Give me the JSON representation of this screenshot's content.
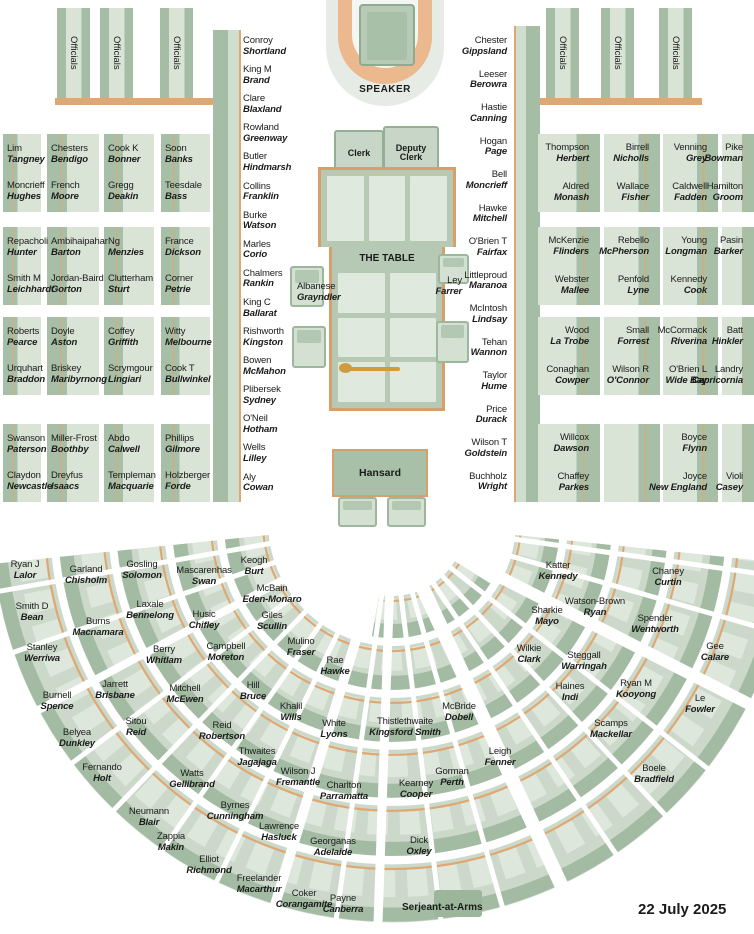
{
  "meta": {
    "date": "22 July 2025"
  },
  "labels": {
    "speaker": "SPEAKER",
    "clerk": "Clerk",
    "deputy_clerk": "Deputy Clerk",
    "the_table": "THE TABLE",
    "hansard": "Hansard",
    "serjeant": "Serjeant-at-Arms",
    "officials": "Officials"
  },
  "colors": {
    "bench_dark": "#a4bda4",
    "bench_light": "#d9e4d7",
    "accent_tan": "#dfa873",
    "mace_gold": "#d09a3e"
  },
  "table_seats": {
    "left": {
      "name": "Albanese",
      "electorate": "Grayndler"
    },
    "right": {
      "name": "Ley",
      "electorate": "Farrer"
    }
  },
  "left_bench_rows": [
    [
      [
        {
          "name": "Lim",
          "electorate": "Tangney"
        },
        {
          "name": "Moncrieff",
          "electorate": "Hughes"
        }
      ],
      [
        {
          "name": "Chesters",
          "electorate": "Bendigo"
        },
        {
          "name": "French",
          "electorate": "Moore"
        }
      ],
      [
        {
          "name": "Cook K",
          "electorate": "Bonner"
        },
        {
          "name": "Gregg",
          "electorate": "Deakin"
        }
      ],
      [
        {
          "name": "Soon",
          "electorate": "Banks"
        },
        {
          "name": "Teesdale",
          "electorate": "Bass"
        }
      ]
    ],
    [
      [
        {
          "name": "Repacholi",
          "electorate": "Hunter"
        },
        {
          "name": "Smith M",
          "electorate": "Leichhardt"
        }
      ],
      [
        {
          "name": "Ambihaipahar",
          "electorate": "Barton"
        },
        {
          "name": "Jordan-Baird",
          "electorate": "Gorton"
        }
      ],
      [
        {
          "name": "Ng",
          "electorate": "Menzies"
        },
        {
          "name": "Clutterham",
          "electorate": "Sturt"
        }
      ],
      [
        {
          "name": "France",
          "electorate": "Dickson"
        },
        {
          "name": "Corner",
          "electorate": "Petrie"
        }
      ]
    ],
    [
      [
        {
          "name": "Roberts",
          "electorate": "Pearce"
        },
        {
          "name": "Urquhart",
          "electorate": "Braddon"
        }
      ],
      [
        {
          "name": "Doyle",
          "electorate": "Aston"
        },
        {
          "name": "Briskey",
          "electorate": "Maribyrnong"
        }
      ],
      [
        {
          "name": "Coffey",
          "electorate": "Griffith"
        },
        {
          "name": "Scrymgour",
          "electorate": "Lingiari"
        }
      ],
      [
        {
          "name": "Witty",
          "electorate": "Melbourne"
        },
        {
          "name": "Cook T",
          "electorate": "Bullwinkel"
        }
      ]
    ],
    [
      [
        {
          "name": "Swanson",
          "electorate": "Paterson"
        },
        {
          "name": "Claydon",
          "electorate": "Newcastle"
        }
      ],
      [
        {
          "name": "Miller-Frost",
          "electorate": "Boothby"
        },
        {
          "name": "Dreyfus",
          "electorate": "Isaacs"
        }
      ],
      [
        {
          "name": "Abdo",
          "electorate": "Calwell"
        },
        {
          "name": "Templeman",
          "electorate": "Macquarie"
        }
      ],
      [
        {
          "name": "Phillips",
          "electorate": "Gilmore"
        },
        {
          "name": "Holzberger",
          "electorate": "Forde"
        }
      ]
    ]
  ],
  "right_bench_rows": [
    [
      [
        {
          "name": "Thompson",
          "electorate": "Herbert"
        },
        {
          "name": "Aldred",
          "electorate": "Monash"
        }
      ],
      [
        {
          "name": "Birrell",
          "electorate": "Nicholls"
        },
        {
          "name": "Wallace",
          "electorate": "Fisher"
        }
      ],
      [
        {
          "name": "Venning",
          "electorate": "Grey"
        },
        {
          "name": "Caldwell",
          "electorate": "Fadden"
        }
      ],
      [
        {
          "name": "Pike",
          "electorate": "Bowman"
        },
        {
          "name": "Hamilton",
          "electorate": "Groom"
        }
      ]
    ],
    [
      [
        {
          "name": "McKenzie",
          "electorate": "Flinders"
        },
        {
          "name": "Webster",
          "electorate": "Mallee"
        }
      ],
      [
        {
          "name": "Rebello",
          "electorate": "McPherson"
        },
        {
          "name": "Penfold",
          "electorate": "Lyne"
        }
      ],
      [
        {
          "name": "Young",
          "electorate": "Longman"
        },
        {
          "name": "Kennedy",
          "electorate": "Cook"
        }
      ],
      [
        {
          "name": "Pasin",
          "electorate": "Barker"
        },
        null
      ]
    ],
    [
      [
        {
          "name": "Wood",
          "electorate": "La Trobe"
        },
        {
          "name": "Conaghan",
          "electorate": "Cowper"
        }
      ],
      [
        {
          "name": "Small",
          "electorate": "Forrest"
        },
        {
          "name": "Wilson R",
          "electorate": "O'Connor"
        }
      ],
      [
        {
          "name": "McCormack",
          "electorate": "Riverina"
        },
        {
          "name": "O'Brien L",
          "electorate": "Wide Bay"
        }
      ],
      [
        {
          "name": "Batt",
          "electorate": "Hinkler"
        },
        {
          "name": "Landry",
          "electorate": "Capricornia"
        }
      ]
    ],
    [
      [
        {
          "name": "Willcox",
          "electorate": "Dawson"
        },
        {
          "name": "Chaffey",
          "electorate": "Parkes"
        }
      ],
      [
        null,
        null
      ],
      [
        {
          "name": "Boyce",
          "electorate": "Flynn"
        },
        {
          "name": "Joyce",
          "electorate": "New England"
        }
      ],
      [
        null,
        {
          "name": "Violi",
          "electorate": "Casey"
        }
      ]
    ]
  ],
  "front_bench_left": [
    {
      "name": "Conroy",
      "electorate": "Shortland"
    },
    {
      "name": "King M",
      "electorate": "Brand"
    },
    {
      "name": "Clare",
      "electorate": "Blaxland"
    },
    {
      "name": "Rowland",
      "electorate": "Greenway"
    },
    {
      "name": "Butler",
      "electorate": "Hindmarsh"
    },
    {
      "name": "Collins",
      "electorate": "Franklin"
    },
    {
      "name": "Burke",
      "electorate": "Watson"
    },
    {
      "name": "Marles",
      "electorate": "Corio"
    },
    {
      "name": "Chalmers",
      "electorate": "Rankin"
    },
    {
      "name": "King C",
      "electorate": "Ballarat"
    },
    {
      "name": "Rishworth",
      "electorate": "Kingston"
    },
    {
      "name": "Bowen",
      "electorate": "McMahon"
    },
    {
      "name": "Plibersek",
      "electorate": "Sydney"
    },
    {
      "name": "O'Neil",
      "electorate": "Hotham"
    },
    {
      "name": "Wells",
      "electorate": "Lilley"
    },
    {
      "name": "Aly",
      "electorate": "Cowan"
    }
  ],
  "front_bench_right": [
    {
      "name": "Chester",
      "electorate": "Gippsland"
    },
    {
      "name": "Leeser",
      "electorate": "Berowra"
    },
    {
      "name": "Hastie",
      "electorate": "Canning"
    },
    {
      "name": "Hogan",
      "electorate": "Page"
    },
    {
      "name": "Bell",
      "electorate": "Moncrieff"
    },
    {
      "name": "Hawke",
      "electorate": "Mitchell"
    },
    {
      "name": "O'Brien T",
      "electorate": "Fairfax"
    },
    {
      "name": "Littleproud",
      "electorate": "Maranoa"
    },
    {
      "name": "McIntosh",
      "electorate": "Lindsay"
    },
    {
      "name": "Tehan",
      "electorate": "Wannon"
    },
    {
      "name": "Taylor",
      "electorate": "Hume"
    },
    {
      "name": "Price",
      "electorate": "Durack"
    },
    {
      "name": "Wilson T",
      "electorate": "Goldstein"
    },
    {
      "name": "Buchholz",
      "electorate": "Wright"
    }
  ],
  "fan_seats": [
    {
      "name": "Ryan J",
      "electorate": "Lalor",
      "x": 25,
      "y": 560
    },
    {
      "name": "Garland",
      "electorate": "Chisholm",
      "x": 86,
      "y": 565
    },
    {
      "name": "Gosling",
      "electorate": "Solomon",
      "x": 142,
      "y": 560
    },
    {
      "name": "Mascarenhas",
      "electorate": "Swan",
      "x": 204,
      "y": 566
    },
    {
      "name": "Keogh",
      "electorate": "Burt",
      "x": 254,
      "y": 556
    },
    {
      "name": "Smith D",
      "electorate": "Bean",
      "x": 32,
      "y": 602
    },
    {
      "name": "Burns",
      "electorate": "Macnamara",
      "x": 98,
      "y": 617
    },
    {
      "name": "Laxale",
      "electorate": "Bennelong",
      "x": 150,
      "y": 600
    },
    {
      "name": "Husic",
      "electorate": "Chifley",
      "x": 204,
      "y": 610
    },
    {
      "name": "McBain",
      "electorate": "Eden-Monaro",
      "x": 272,
      "y": 584
    },
    {
      "name": "Stanley",
      "electorate": "Werriwa",
      "x": 42,
      "y": 643
    },
    {
      "name": "Berry",
      "electorate": "Whitlam",
      "x": 164,
      "y": 645
    },
    {
      "name": "Campbell",
      "electorate": "Moreton",
      "x": 226,
      "y": 642
    },
    {
      "name": "Giles",
      "electorate": "Scullin",
      "x": 272,
      "y": 611
    },
    {
      "name": "Mulino",
      "electorate": "Fraser",
      "x": 301,
      "y": 637
    },
    {
      "name": "Rae",
      "electorate": "Hawke",
      "x": 335,
      "y": 656
    },
    {
      "name": "Burnell",
      "electorate": "Spence",
      "x": 57,
      "y": 691
    },
    {
      "name": "Jarrett",
      "electorate": "Brisbane",
      "x": 115,
      "y": 680
    },
    {
      "name": "Mitchell",
      "electorate": "McEwen",
      "x": 185,
      "y": 684
    },
    {
      "name": "Hill",
      "electorate": "Bruce",
      "x": 253,
      "y": 681
    },
    {
      "name": "Khalil",
      "electorate": "Wills",
      "x": 291,
      "y": 702
    },
    {
      "name": "White",
      "electorate": "Lyons",
      "x": 334,
      "y": 719
    },
    {
      "name": "Belyea",
      "electorate": "Dunkley",
      "x": 77,
      "y": 728
    },
    {
      "name": "Sitou",
      "electorate": "Reid",
      "x": 136,
      "y": 717
    },
    {
      "name": "Reid",
      "electorate": "Robertson",
      "x": 222,
      "y": 721
    },
    {
      "name": "Thwaites",
      "electorate": "Jagajaga",
      "x": 257,
      "y": 747
    },
    {
      "name": "Fernando",
      "electorate": "Holt",
      "x": 102,
      "y": 763
    },
    {
      "name": "Watts",
      "electorate": "Gellibrand",
      "x": 192,
      "y": 769
    },
    {
      "name": "Wilson J",
      "electorate": "Fremantle",
      "x": 298,
      "y": 767
    },
    {
      "name": "Charlton",
      "electorate": "Parramatta",
      "x": 344,
      "y": 781
    },
    {
      "name": "Neumann",
      "electorate": "Blair",
      "x": 149,
      "y": 807
    },
    {
      "name": "Byrnes",
      "electorate": "Cunningham",
      "x": 235,
      "y": 801
    },
    {
      "name": "Zappia",
      "electorate": "Makin",
      "x": 171,
      "y": 832
    },
    {
      "name": "Lawrence",
      "electorate": "Hasluck",
      "x": 279,
      "y": 822
    },
    {
      "name": "Elliot",
      "electorate": "Richmond",
      "x": 209,
      "y": 855
    },
    {
      "name": "Georganas",
      "electorate": "Adelaide",
      "x": 333,
      "y": 837
    },
    {
      "name": "Freelander",
      "electorate": "Macarthur",
      "x": 259,
      "y": 874
    },
    {
      "name": "Coker",
      "electorate": "Corangamite",
      "x": 304,
      "y": 889
    },
    {
      "name": "Payne",
      "electorate": "Canberra",
      "x": 343,
      "y": 894
    },
    {
      "name": "Thistlethwaite",
      "electorate": "Kingsford Smith",
      "x": 405,
      "y": 717
    },
    {
      "name": "McBride",
      "electorate": "Dobell",
      "x": 459,
      "y": 702
    },
    {
      "name": "Leigh",
      "electorate": "Fenner",
      "x": 500,
      "y": 747
    },
    {
      "name": "Gorman",
      "electorate": "Perth",
      "x": 452,
      "y": 767
    },
    {
      "name": "Kearney",
      "electorate": "Cooper",
      "x": 416,
      "y": 779
    },
    {
      "name": "Dick",
      "electorate": "Oxley",
      "x": 419,
      "y": 836
    },
    {
      "name": "Katter",
      "electorate": "Kennedy",
      "x": 558,
      "y": 561
    },
    {
      "name": "Sharkie",
      "electorate": "Mayo",
      "x": 547,
      "y": 606
    },
    {
      "name": "Wilkie",
      "electorate": "Clark",
      "x": 529,
      "y": 644
    },
    {
      "name": "Watson-Brown",
      "electorate": "Ryan",
      "x": 595,
      "y": 597
    },
    {
      "name": "Steggall",
      "electorate": "Warringah",
      "x": 584,
      "y": 651
    },
    {
      "name": "Haines",
      "electorate": "Indi",
      "x": 570,
      "y": 682
    },
    {
      "name": "Chaney",
      "electorate": "Curtin",
      "x": 668,
      "y": 567
    },
    {
      "name": "Spender",
      "electorate": "Wentworth",
      "x": 655,
      "y": 614
    },
    {
      "name": "Gee",
      "electorate": "Calare",
      "x": 715,
      "y": 642
    },
    {
      "name": "Ryan M",
      "electorate": "Kooyong",
      "x": 636,
      "y": 679
    },
    {
      "name": "Le",
      "electorate": "Fowler",
      "x": 700,
      "y": 694
    },
    {
      "name": "Scamps",
      "electorate": "Mackellar",
      "x": 611,
      "y": 719
    },
    {
      "name": "Boele",
      "electorate": "Bradfield",
      "x": 654,
      "y": 764
    }
  ]
}
